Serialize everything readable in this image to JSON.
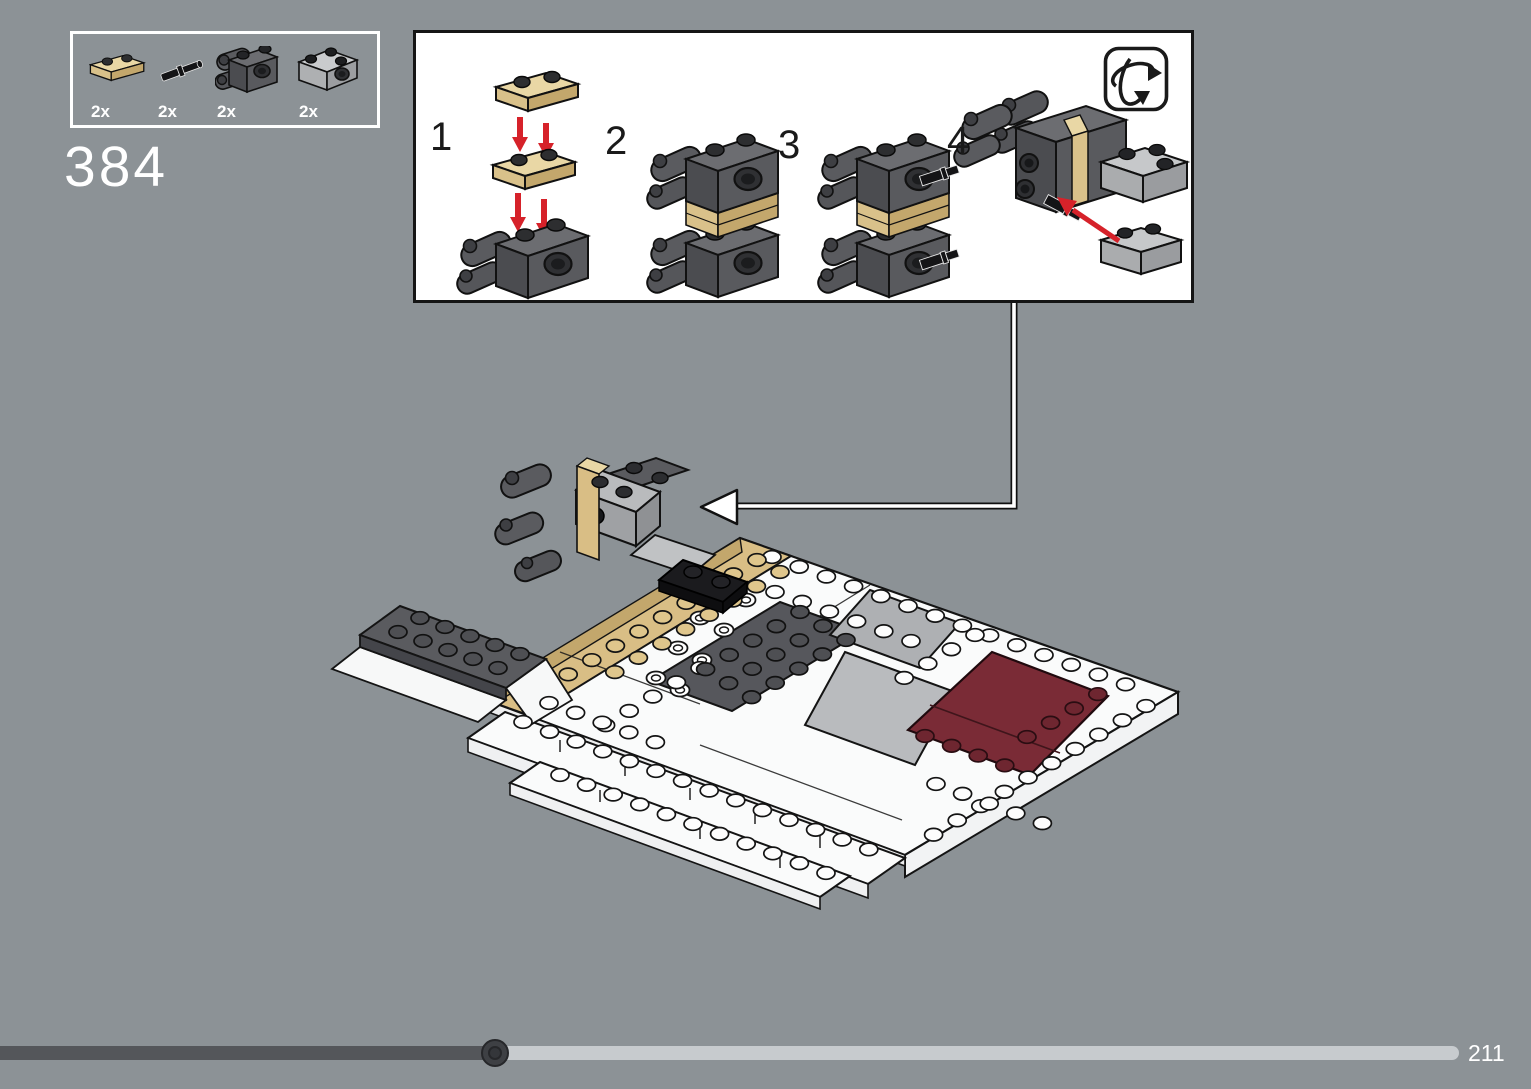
{
  "header": {
    "step_number": "384"
  },
  "parts_box": {
    "items": [
      {
        "label": "2x",
        "part": "tan-1x2-plate"
      },
      {
        "label": "2x",
        "part": "black-pin-connector"
      },
      {
        "label": "2x",
        "part": "dark-gray-technic-brick-with-arms"
      },
      {
        "label": "2x",
        "part": "light-gray-2x2-brick-with-pin-hole"
      }
    ]
  },
  "instructions": {
    "substeps": [
      {
        "number": "1"
      },
      {
        "number": "2"
      },
      {
        "number": "3"
      },
      {
        "number": "4"
      }
    ],
    "rotate_icon": "rotate-model"
  },
  "footer": {
    "page_number": "211",
    "progress_percent": 34
  },
  "colors": {
    "background": "#8C9296",
    "tan": "#D9BE85",
    "dark_red_panel": "#7A2B36",
    "arrow_red": "#D6222A",
    "progress_dark": "#54565A",
    "progress_light": "#C7CBCE"
  }
}
